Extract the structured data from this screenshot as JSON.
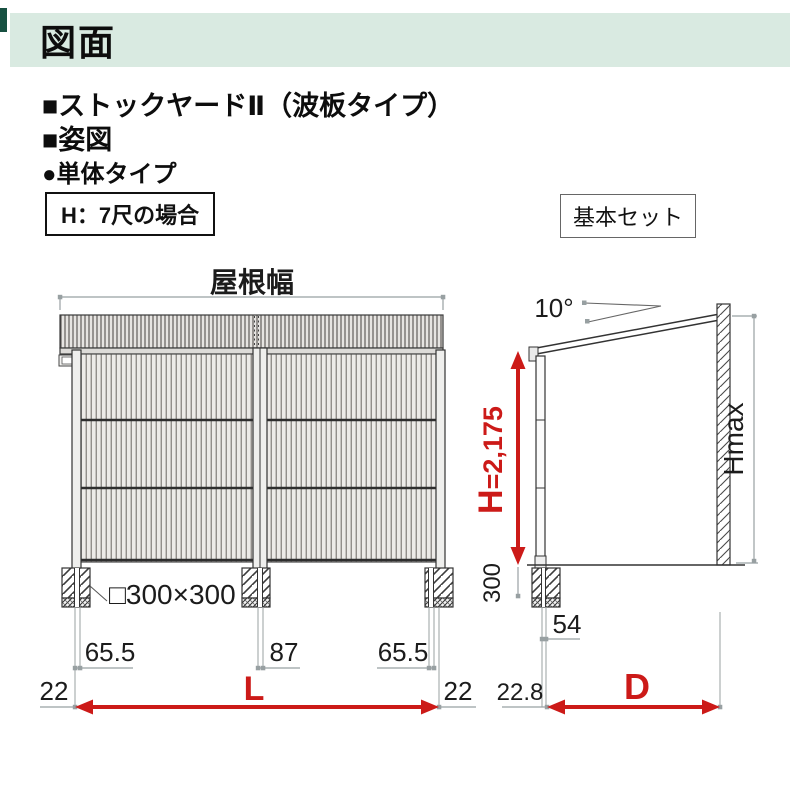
{
  "header": {
    "title": "図面"
  },
  "product": {
    "line1": "■ストックヤードⅡ（波板タイプ）",
    "line2": "■姿図",
    "line3": "●単体タイプ",
    "height_case_badge": "H：7尺の場合",
    "set_badge": "基本セット"
  },
  "front_view": {
    "roof_width_label": "屋根幅",
    "foundation_size_label": "□300×300",
    "dim_left_offset": "65.5",
    "dim_center_gap": "87",
    "dim_right_offset": "65.5",
    "dim_left_edge": "22",
    "dim_right_edge": "22",
    "dim_width_symbol": "L"
  },
  "side_view": {
    "roof_angle_label": "10°",
    "dim_height_symbol": "H",
    "dim_height_value": "=2,175",
    "dim_foundation_depth": "300",
    "dim_max_height_label": "Hmax",
    "dim_post_offset": "54",
    "dim_front_edge": "22.8",
    "dim_depth_symbol": "D"
  },
  "colors": {
    "accent_red": "#cc1a18",
    "header_bg": "#d9eae1",
    "header_accent": "#175041",
    "line_dark": "#333333",
    "line_gray": "#98a0a2"
  }
}
